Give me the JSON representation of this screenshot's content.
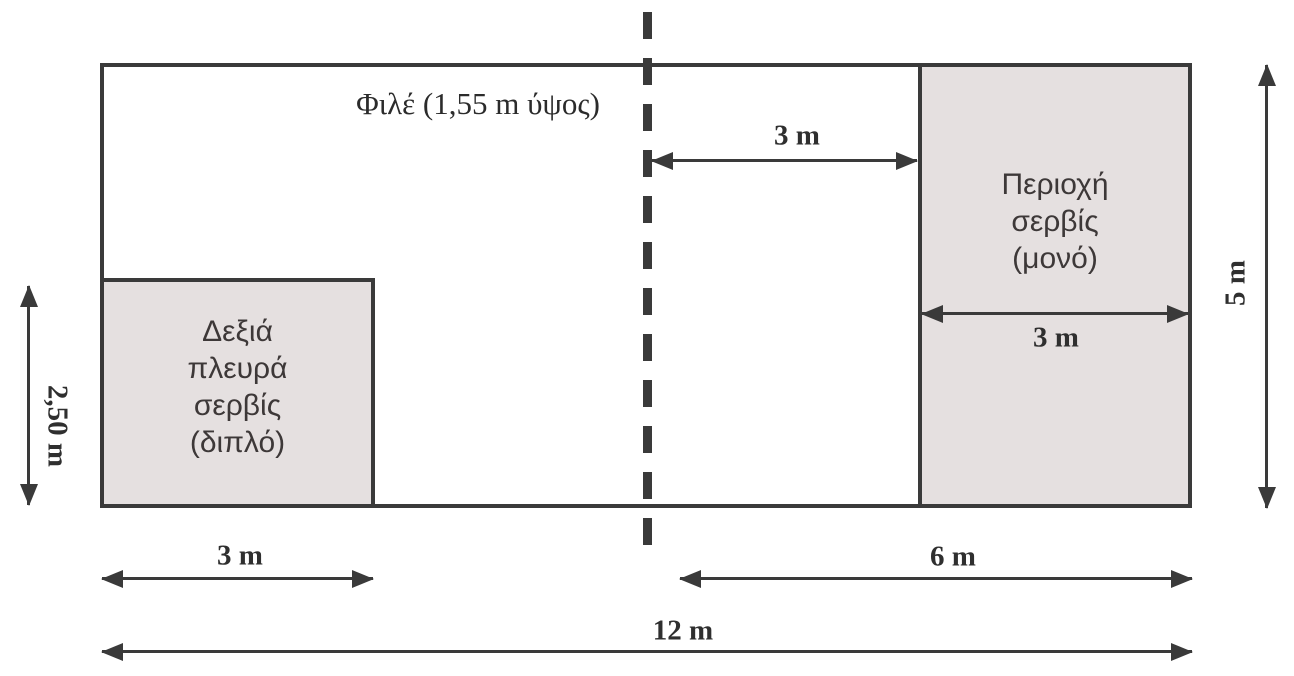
{
  "court": {
    "net_label": "Φιλέ (1,55 m ύψος)",
    "left_service_zone": {
      "line1": "Δεξιά",
      "line2": "πλευρά",
      "line3": "σερβίς",
      "line4": "(διπλό)"
    },
    "right_service_zone": {
      "line1": "Περιοχή",
      "line2": "σερβίς",
      "line3": "(μονό)"
    },
    "dimensions": {
      "net_to_service_line": "3 m",
      "right_zone_width": "3 m",
      "court_height": "5 m",
      "left_zone_height": "2,50 m",
      "left_zone_width": "3 m",
      "half_court_width": "6 m",
      "total_width": "12 m"
    },
    "colors": {
      "line": "#3a3a3a",
      "zone_fill": "#e5e0e0",
      "background": "#ffffff"
    }
  }
}
